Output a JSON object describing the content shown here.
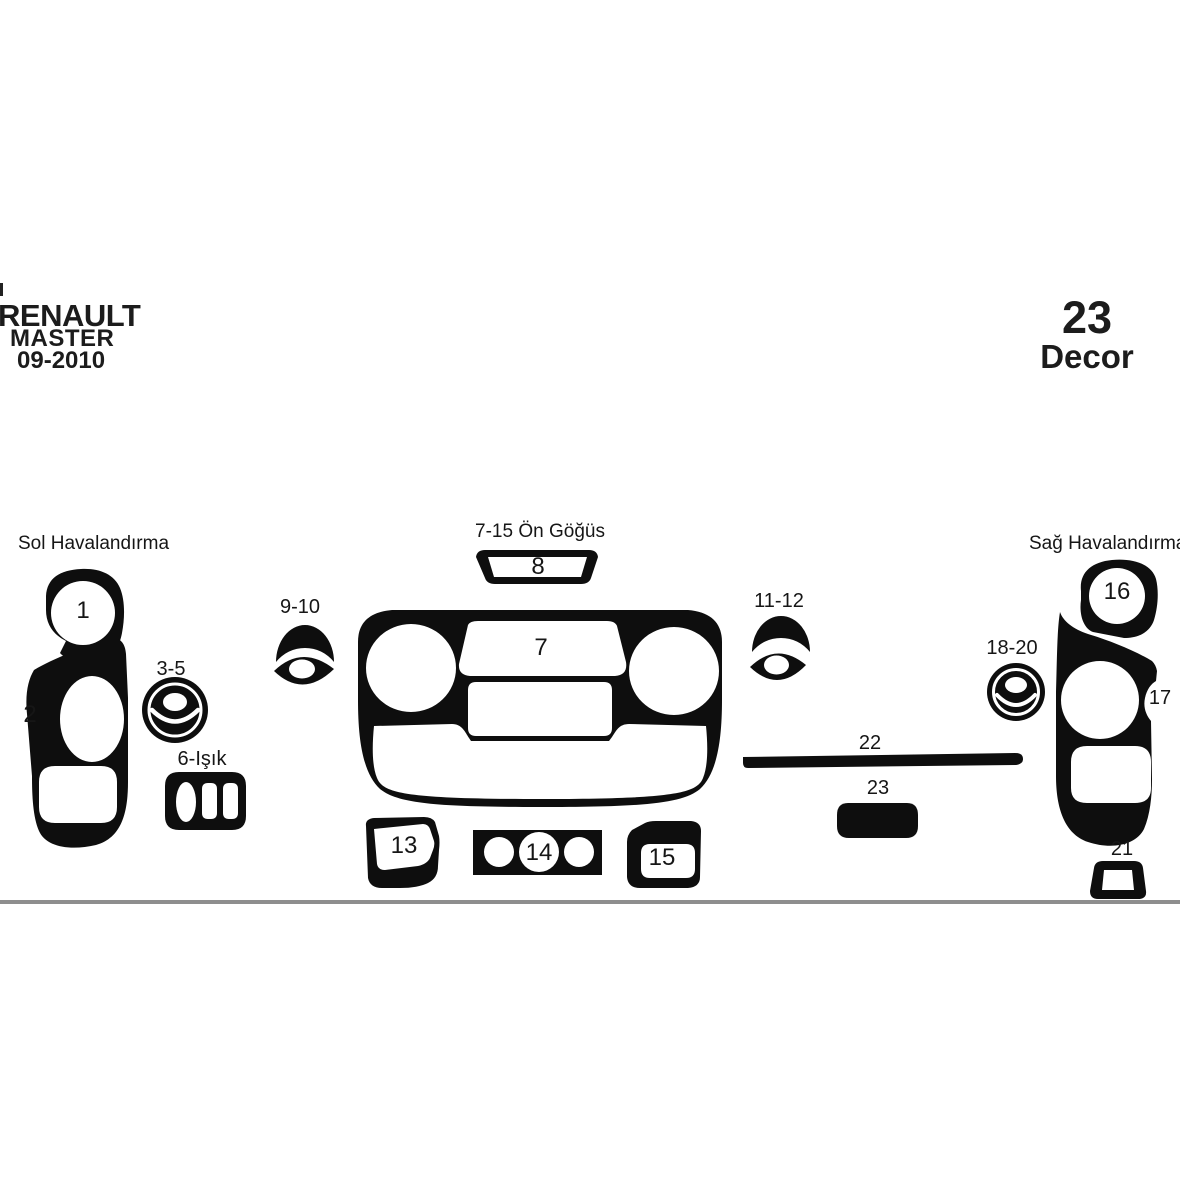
{
  "header": {
    "brand": "RENAULT",
    "model": "MASTER",
    "year": "09-2010",
    "piece_count": "23",
    "piece_caption": "Decor"
  },
  "diagram": {
    "groups": {
      "left": "Sol Havalandırma",
      "center": "7-15 Ön Göğüs",
      "right": "Sağ Havalandırma"
    },
    "labels": {
      "p1": "1",
      "p2": "2",
      "p3_5": "3-5",
      "p6": "6-Işık",
      "p7": "7",
      "p8": "8",
      "p9_10": "9-10",
      "p11_12": "11-12",
      "p13": "13",
      "p14": "14",
      "p15": "15",
      "p16": "16",
      "p17": "17",
      "p18_20": "18-20",
      "p21": "21",
      "p22": "22",
      "p23": "23"
    },
    "colors": {
      "piece": "#0e0e0e",
      "divider": "#8e8e8e",
      "background": "#ffffff",
      "text": "#161616"
    }
  }
}
